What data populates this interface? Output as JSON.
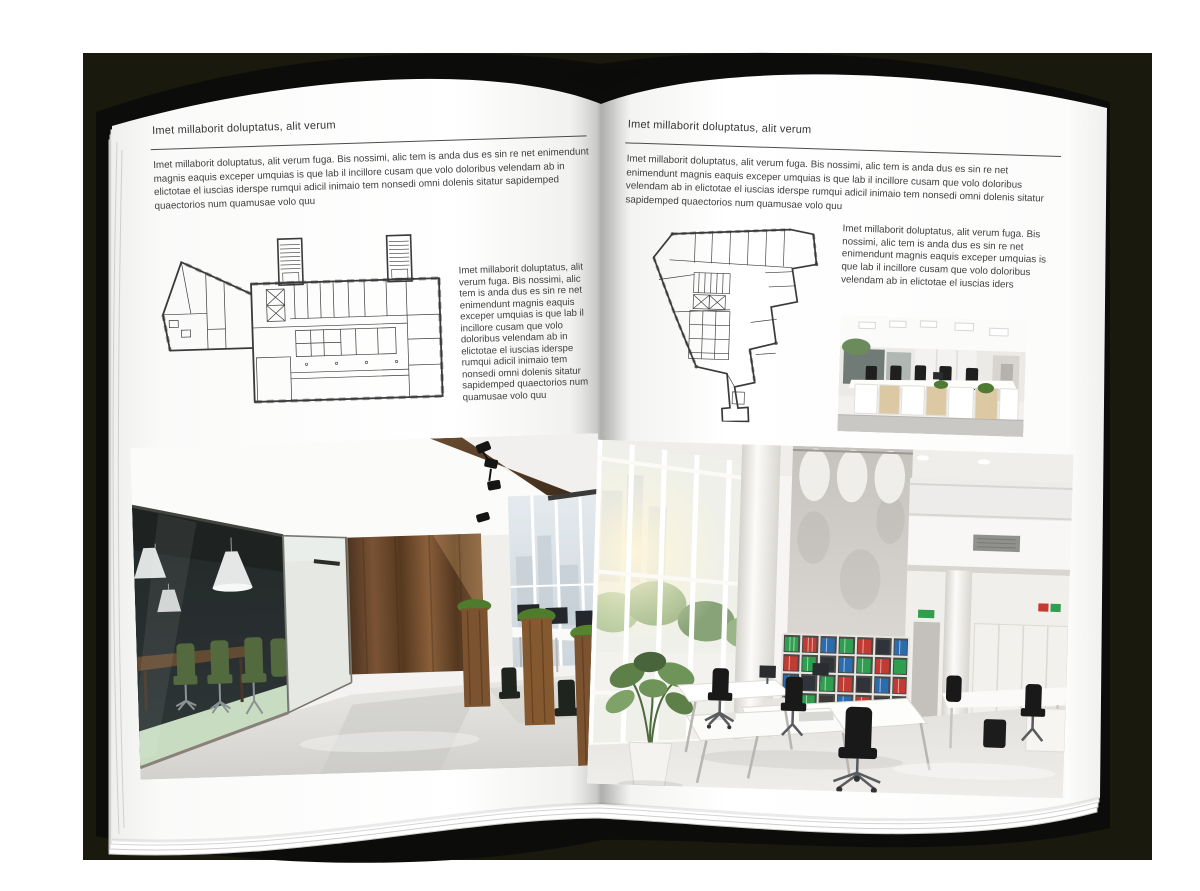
{
  "colors": {
    "backdrop": "#1a190e",
    "cover": "#0c0c0a",
    "page": "#ffffff",
    "text": "#3c3c3c",
    "rule": "#4c4c4c",
    "plan_line": "#3a3a3a",
    "binder_red": "#c23b32",
    "binder_green": "#2f9e4f",
    "binder_blue": "#2b6cb0",
    "chair_green": "#4b6133",
    "wood": "#6b4a2c"
  },
  "left_page": {
    "header": "Imet millaborit doluptatus, alit verum",
    "intro": "Imet millaborit doluptatus, alit verum fuga. Bis nossimi, alic tem is anda dus es sin re net enimendunt magnis eaquis exceper umquias is que lab il incillore cusam que volo doloribus velendam ab in elictotae el iuscias iderspe rumqui adicil inimaio tem nonsedi omni dolenis sitatur sapidemped quaectorios num quamusae volo quu",
    "side_text": "Imet millaborit doluptatus, alit verum fuga. Bis nossimi, alic tem is anda dus es sin re net enimendunt magnis eaquis exceper umquias is que lab il incillore cusam que volo doloribus velendam ab in elictotae el iuscias iderspe rumqui adicil inimaio tem nonsedi omni dolenis sitatur sapidemped quaectorios num quamusae volo quu"
  },
  "right_page": {
    "header": "Imet millaborit doluptatus, alit verum",
    "intro": "Imet millaborit doluptatus, alit verum fuga. Bis nossimi, alic tem is anda dus es sin re net enimendunt magnis eaquis exceper umquias is que lab il incillore cusam que volo doloribus velendam ab in elictotae el iuscias iderspe rumqui adicil inimaio tem nonsedi omni dolenis sitatur sapidemped quaectorios num quamusae volo quu",
    "side_text": "Imet millaborit doluptatus, alit verum fuga. Bis nossimi, alic tem is anda dus es sin re net enimendunt magnis eaquis exceper umquias is que lab il incillore cusam que volo doloribus velendam ab in elictotae el iuscias iders"
  }
}
